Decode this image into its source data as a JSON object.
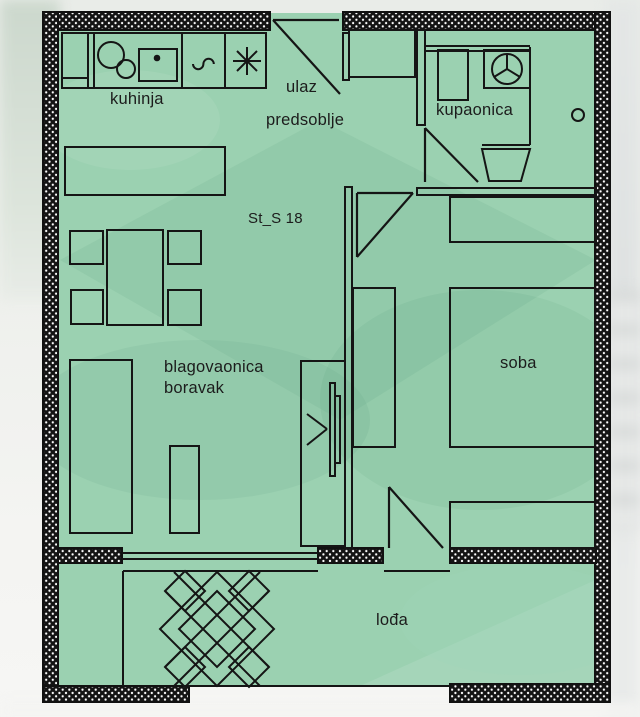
{
  "labels": {
    "kuhinja": "kuhinja",
    "ulaz": "ulaz",
    "predsoblje": "predsoblje",
    "unit": "St_S 18",
    "kupaonica": "kupaonica",
    "blagovaonica": "blagovaonica",
    "boravak": "boravak",
    "soba": "soba",
    "lodja": "lođa"
  },
  "colors": {
    "floor_fill": "#9bd1b1",
    "wall_ink": "#121212",
    "line_ink": "#1a1a1a",
    "backdrop": "#eef0ec"
  },
  "icons": {
    "hob_asterisk": "✳",
    "hob_curve": "∿",
    "washing_machine_drum": "◯ with Y spokes",
    "sink_bowls": "two circles",
    "faucet_dot": "•",
    "vent": "○"
  }
}
